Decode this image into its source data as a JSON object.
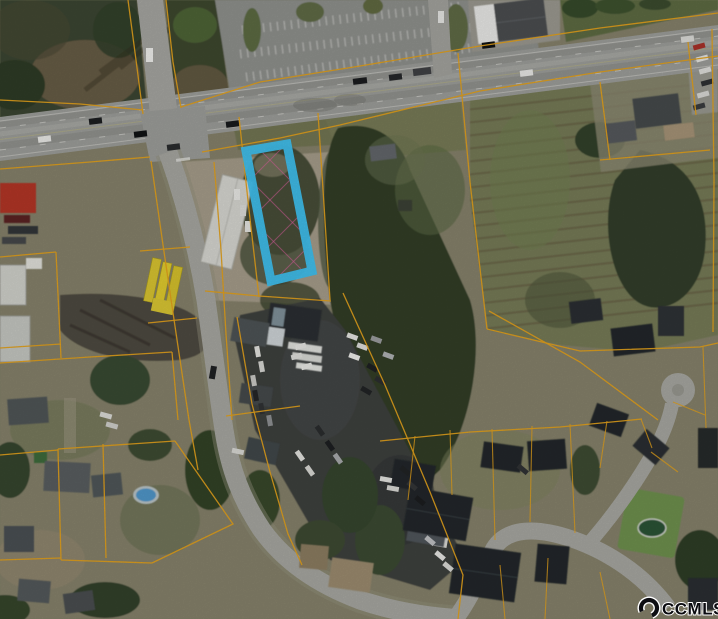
{
  "image": {
    "type": "aerial-parcel-map-photo",
    "subject_parcel_highlighted": true,
    "watermark": {
      "logo": "ccmls-crescent-icon",
      "text": "CCMLS"
    },
    "colors": {
      "highlight_parcel": "#3FC0EE",
      "parcel_boundary": "#E2A01C",
      "hatch": "#E060A0",
      "road": "#9C9D99",
      "watermark_text": "#0B0B10",
      "watermark_halo": "#FFFFFF"
    }
  }
}
